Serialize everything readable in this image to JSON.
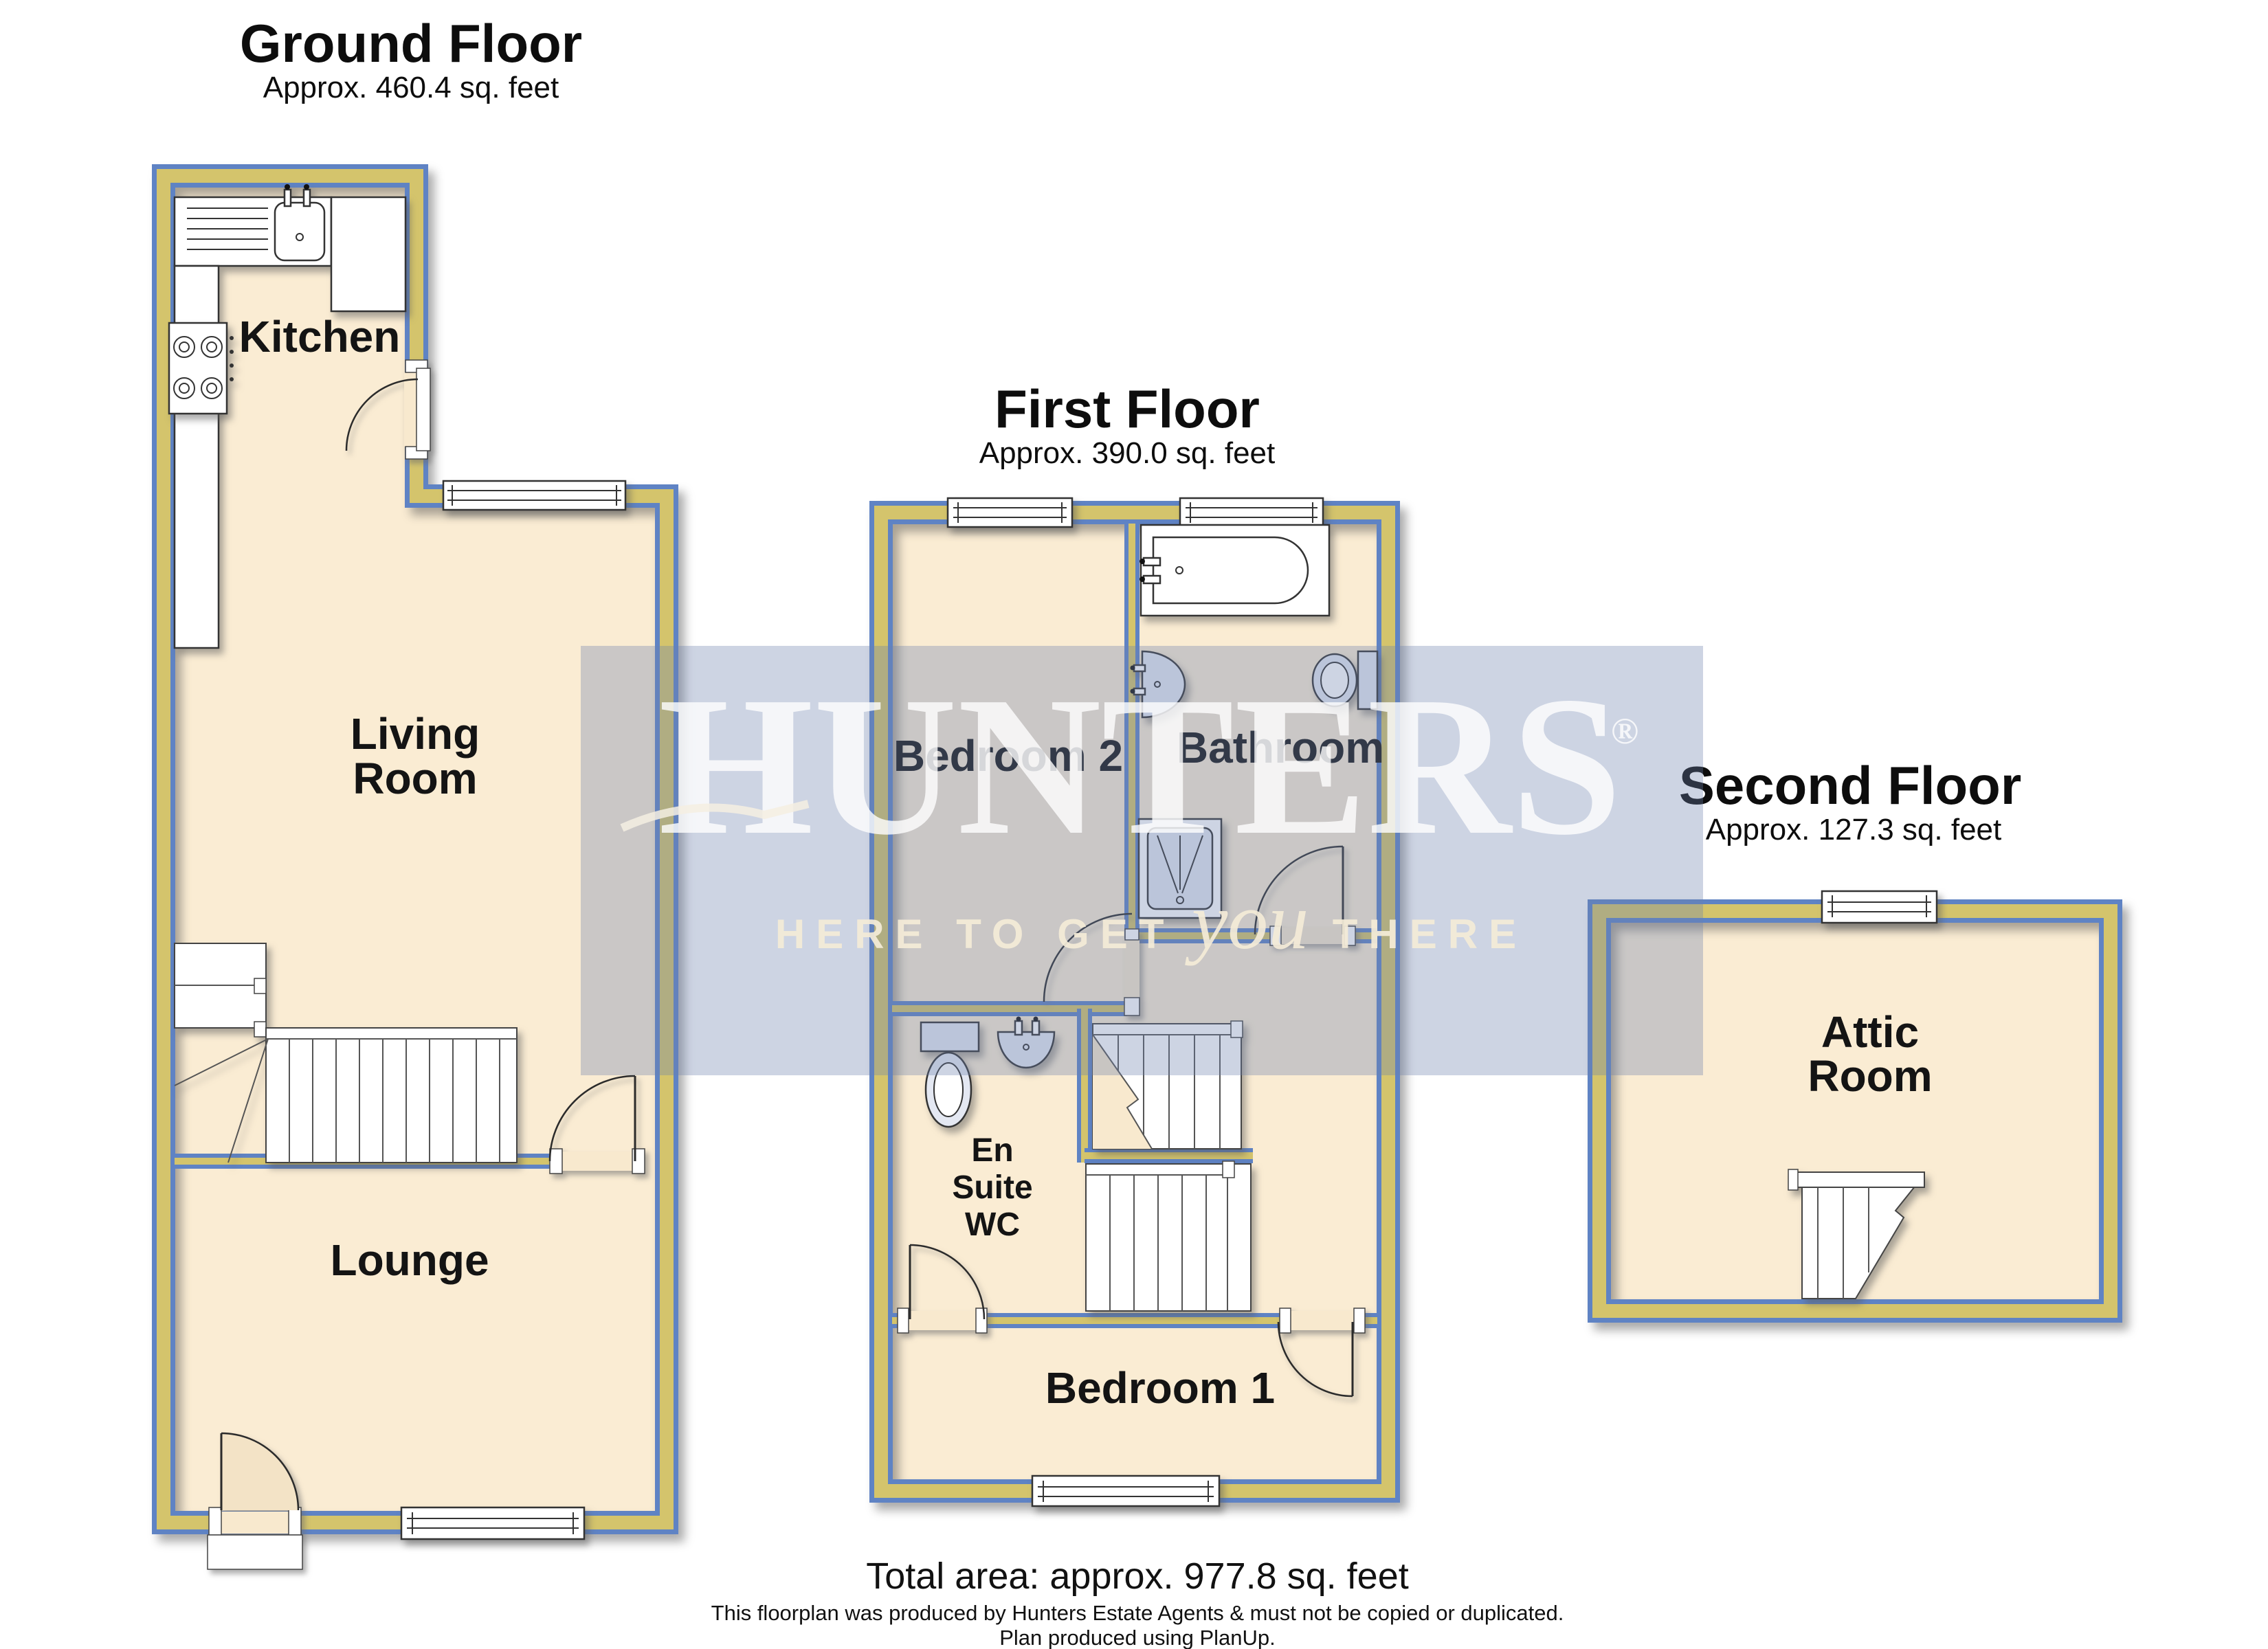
{
  "ground_floor": {
    "title": "Ground Floor",
    "area": "Approx. 460.4 sq. feet",
    "rooms": {
      "kitchen": "Kitchen",
      "living_room": [
        "Living",
        "Room"
      ],
      "lounge": "Lounge"
    }
  },
  "first_floor": {
    "title": "First Floor",
    "area": "Approx. 390.0 sq. feet",
    "rooms": {
      "bedroom2": "Bedroom 2",
      "bathroom": "Bathroom",
      "en_suite": [
        "En",
        "Suite",
        "WC"
      ],
      "bedroom1": "Bedroom 1"
    }
  },
  "second_floor": {
    "title": "Second Floor",
    "area": "Approx. 127.3 sq. feet",
    "rooms": {
      "attic": [
        "Attic",
        "Room"
      ]
    }
  },
  "watermark": {
    "brand": "HUNTERS",
    "registered": "®",
    "tagline_pre": "HERE TO GET",
    "tagline_script": "you",
    "tagline_post": "THERE"
  },
  "footer": {
    "total": "Total area: approx. 977.8 sq. feet",
    "disclaimer1": "This floorplan was produced by Hunters Estate Agents & must not be copied or duplicated.",
    "disclaimer2": "Plan produced using PlanUp."
  },
  "colors": {
    "wall_core": "#D4C46C",
    "wall_edge": "#5F83C4",
    "floor": "#FAECD3",
    "watermark": "#6D81AC",
    "text": "#0d0d0d"
  }
}
